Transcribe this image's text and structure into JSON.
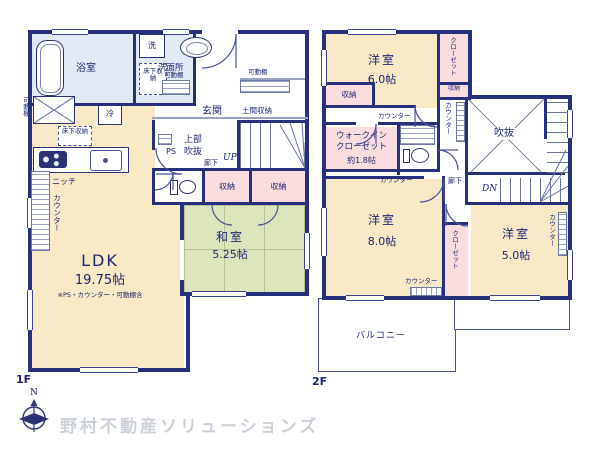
{
  "colors": {
    "wall": "#27307c",
    "room_cream": "#f7e9c5",
    "room_tatami": "#dde5bd",
    "room_pink": "#f9dcdd",
    "room_blue": "#e0e9f4",
    "label_navy": "#1d2670",
    "brand_gray": "#ccd1d9"
  },
  "f1": {
    "floor_label": "1F",
    "bath": "浴室",
    "laundry": "洗",
    "washroom": "洗面所",
    "underfloor_a": "床下収納",
    "underfloor_b": "床下収納",
    "shelf_wash": "可動棚",
    "shelf_left": "可動棚",
    "shelf_entry": "可動棚",
    "fridge": "冷",
    "entrance": "玄関",
    "doma": "土間収納",
    "upper_void_1": "上部",
    "upper_void_2": "吹抜",
    "ps": "PS",
    "up": "UP",
    "hall": "廊下",
    "storage_a": "収納",
    "storage_b": "収納",
    "niche": "ニッチ",
    "counter": "カウンター",
    "ldk_name": "LDK",
    "ldk_size": "19.75帖",
    "ldk_note": "※PS・カウンター・可動棚含",
    "washitsu_name": "和室",
    "washitsu_size": "5.25帖"
  },
  "f2": {
    "floor_label": "2F",
    "bed6_name": "洋室",
    "bed6_size": "6.0帖",
    "bed8_name": "洋室",
    "bed8_size": "8.0帖",
    "bed5_name": "洋室",
    "bed5_size": "5.0帖",
    "closet_a": "クローゼット",
    "closet_b": "クローゼット",
    "closet_c": "クローゼット",
    "storage_a": "収納",
    "storage_b": "収納",
    "counter_a": "カウンター",
    "counter_b": "カウンター",
    "counter_c": "カウンター",
    "counter_d": "カウンター",
    "counter_e": "カウンター",
    "wic_1": "ウォークイン",
    "wic_2": "クローゼット",
    "wic_size": "約1.8帖",
    "void": "吹抜",
    "dn": "DN",
    "hall": "廊下",
    "balcony": "バルコニー"
  },
  "footer": {
    "north": "N",
    "brand": "野村不動産ソリューションズ"
  }
}
